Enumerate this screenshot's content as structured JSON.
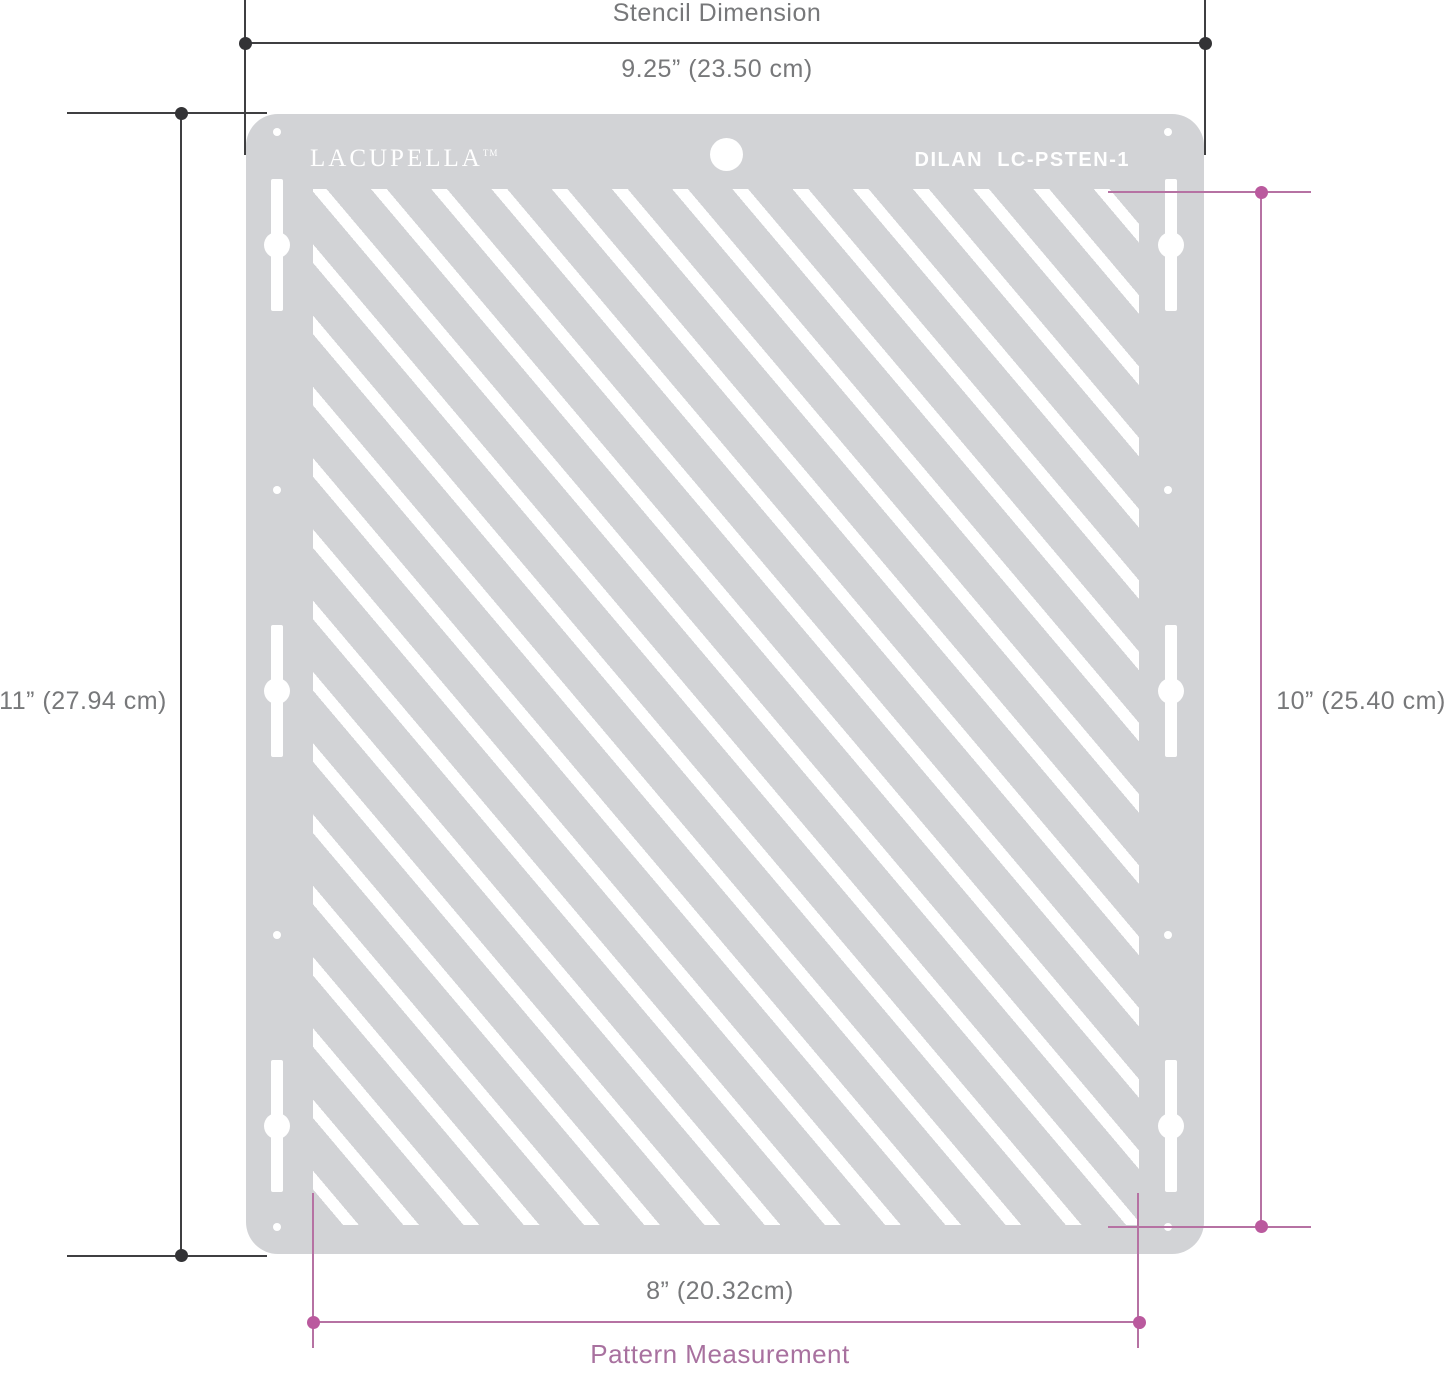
{
  "colors": {
    "background": "#ffffff",
    "stencil": "#d2d3d6",
    "stripe": "#ffffff",
    "dim_dark": "#3f3f41",
    "dim_dark_dot": "#333336",
    "dim_pink": "#b672a3",
    "dim_pink_dot": "#ba5a9e",
    "label_gray": "#77787a",
    "label_pink": "#a8719f",
    "stencil_text": "#ffffff"
  },
  "header": {
    "title": "Stencil Dimension",
    "width_label": "9.25” (23.50 cm)"
  },
  "left": {
    "height_label": "11” (27.94 cm)"
  },
  "right": {
    "pattern_height_label": "10” (25.40 cm)"
  },
  "footer": {
    "pattern_width_label": "8” (20.32cm)",
    "title": "Pattern Measurement"
  },
  "stencil": {
    "brand": "LACUPELLA",
    "brand_tm": "TM",
    "product_code": "DILAN  LC-PSTEN-1",
    "pattern_type": "diagonal-stripes"
  }
}
